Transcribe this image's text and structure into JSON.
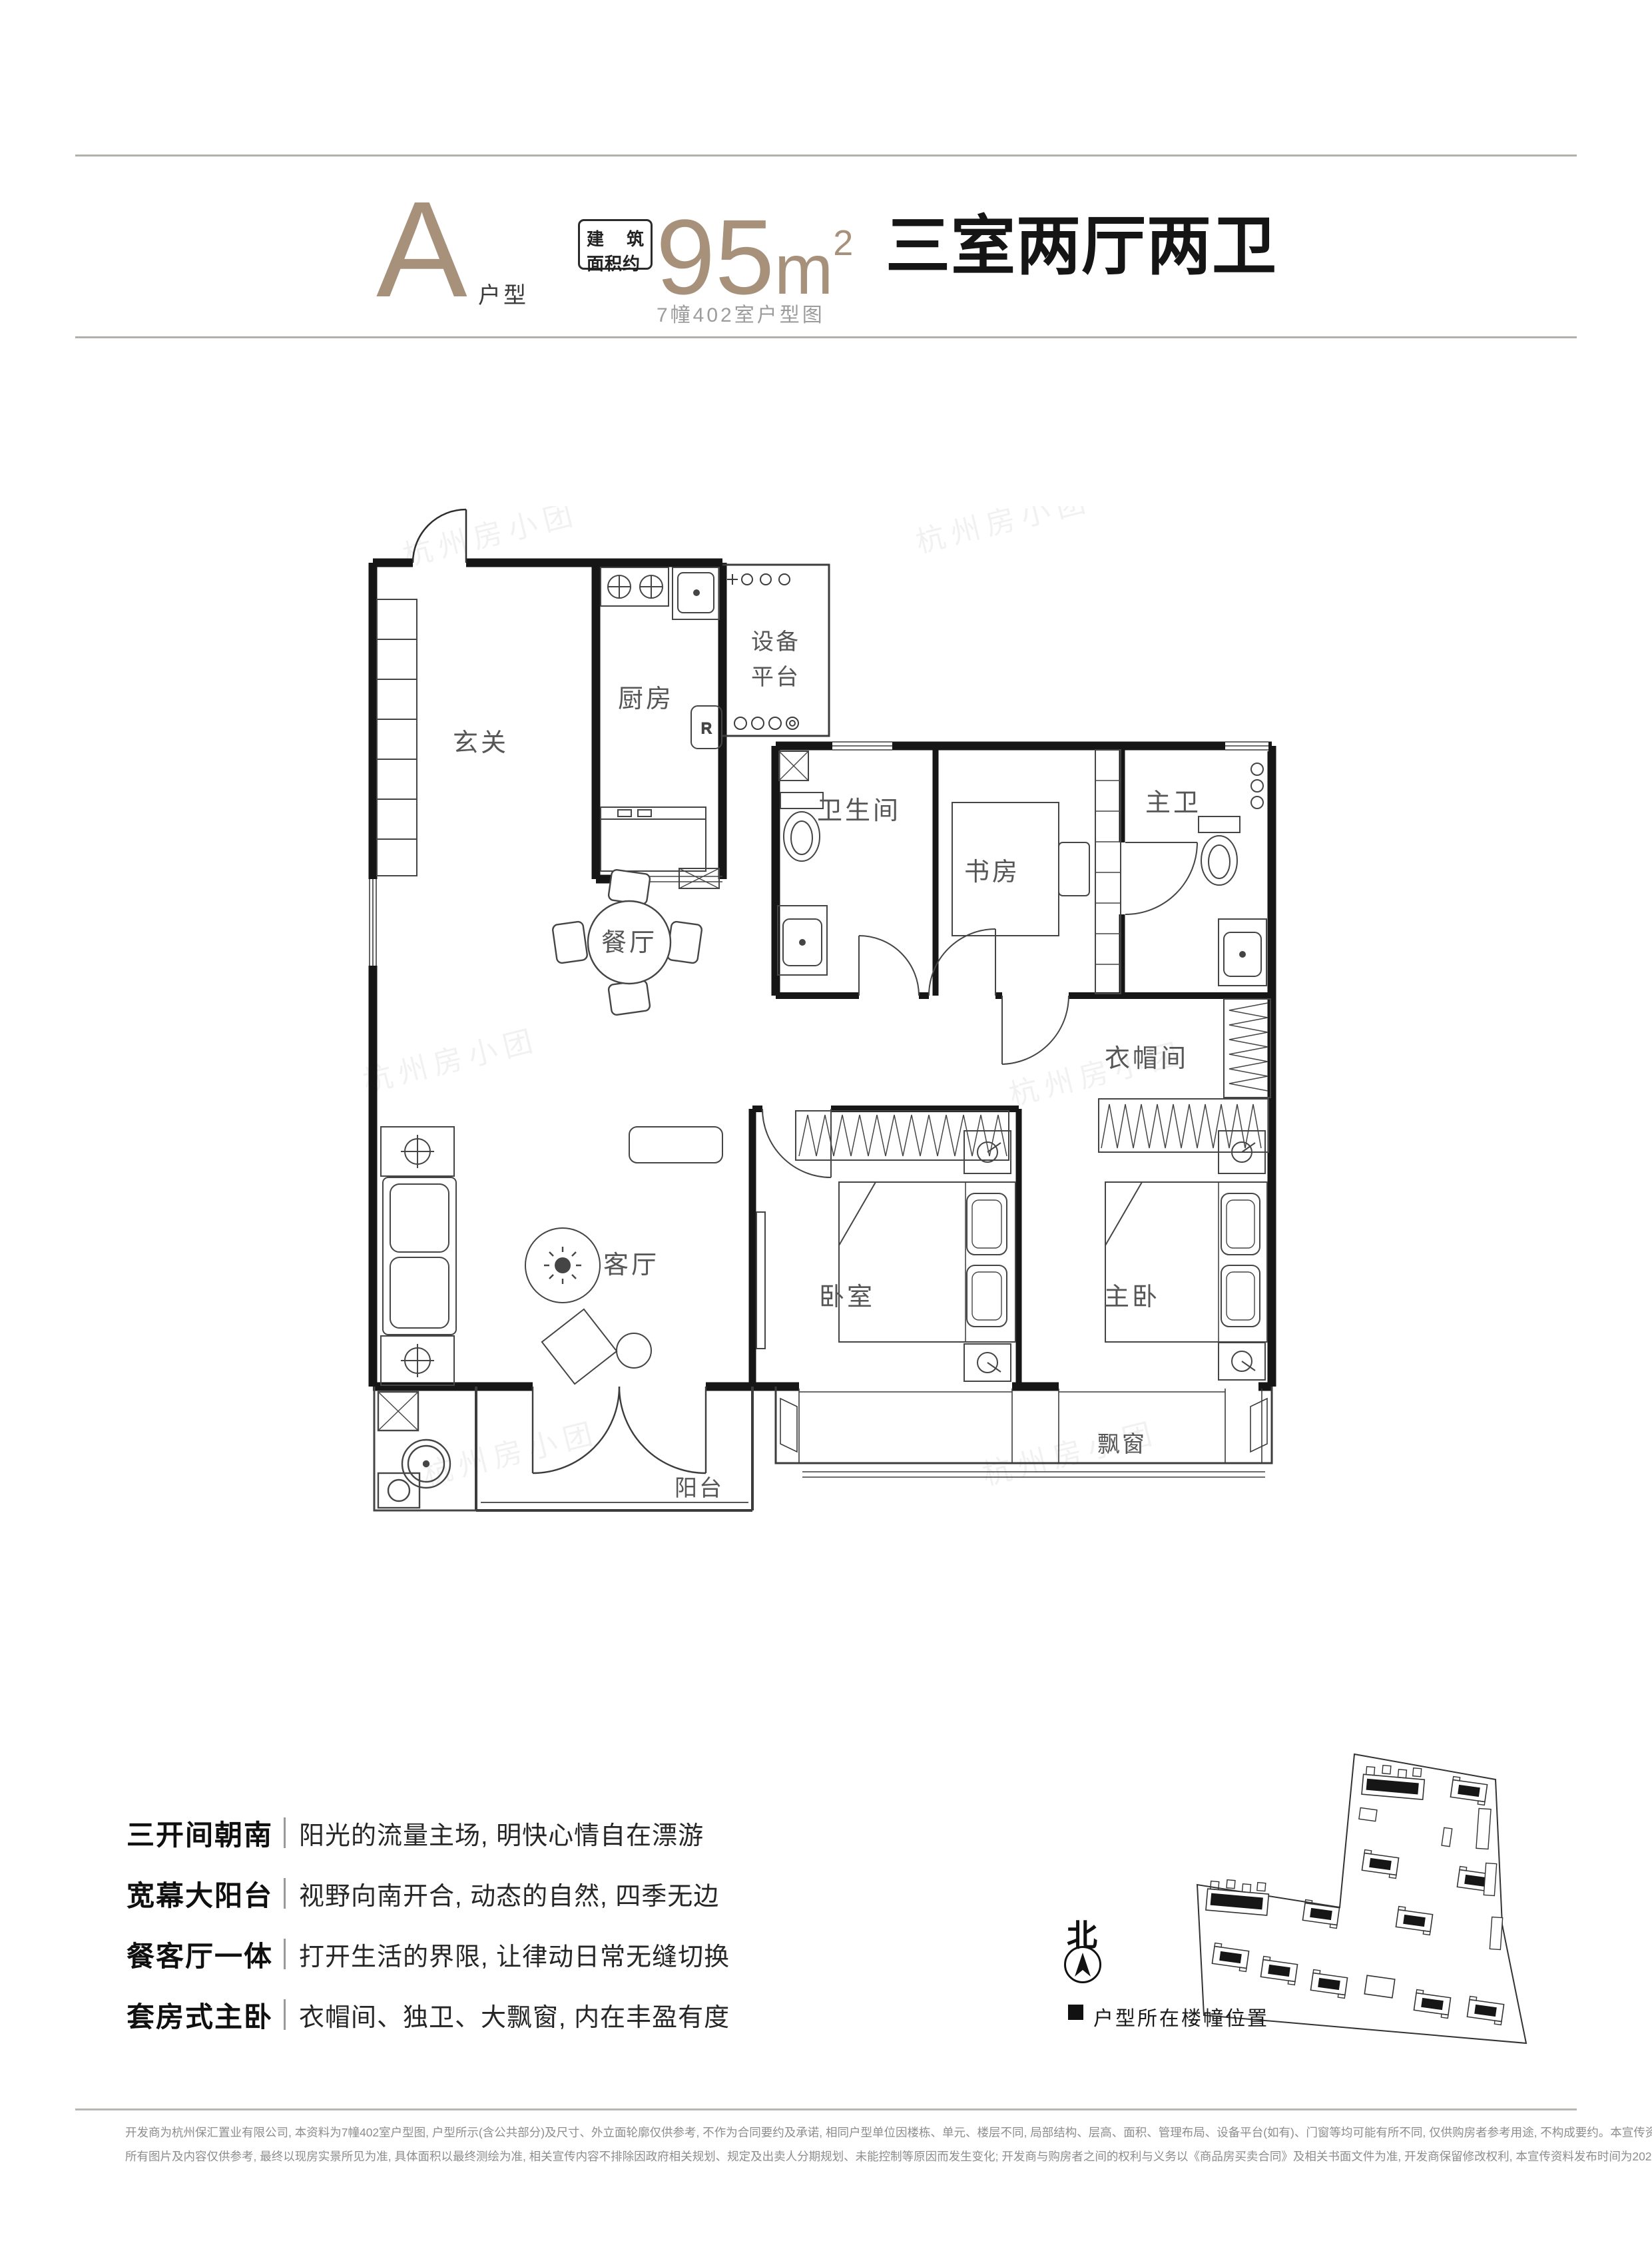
{
  "header": {
    "unit_letter": "A",
    "unit_suffix": "户型",
    "area_box_l1a": "建",
    "area_box_l1b": "筑",
    "area_box_l2": "面积约",
    "area_value": "95",
    "area_unit": "m",
    "area_exponent": "2",
    "headline": "三室两厅两卫",
    "subtitle": "7幢402室户型图"
  },
  "floor_plan": {
    "watermark": "杭州房小团",
    "fridge_label": "R",
    "labels": {
      "entry": "玄关",
      "kitchen": "厨房",
      "platform_1": "设备",
      "platform_2": "平台",
      "bathroom": "卫生间",
      "study": "书房",
      "master_bath": "主卫",
      "dining": "餐厅",
      "cloakroom": "衣帽间",
      "living": "客厅",
      "bedroom": "卧室",
      "master_bedroom": "主卧",
      "bay_window": "飘窗",
      "balcony": "阳台"
    }
  },
  "features": {
    "items": [
      {
        "title": "三开间朝南",
        "desc": "阳光的流量主场, 明快心情自在漂游"
      },
      {
        "title": "宽幕大阳台",
        "desc": "视野向南开合, 动态的自然, 四季无边"
      },
      {
        "title": "餐客厅一体",
        "desc": "打开生活的界限, 让律动日常无缝切换"
      },
      {
        "title": "套房式主卧",
        "desc": "衣帽间、独卫、大飘窗, 内在丰盈有度"
      }
    ]
  },
  "site_plan": {
    "north_label": "北",
    "legend_label": "户型所在楼幢位置"
  },
  "disclaimer": {
    "line1": "开发商为杭州保汇置业有限公司, 本资料为7幢402室户型图, 户型所示(含公共部分)及尺寸、外立面轮廓仅供参考, 不作为合同要约及承诺, 相同户型单位因楼栋、单元、楼层不同, 局部结构、层高、面积、管理布局、设备平台(如有)、门窗等均可能有所不同, 仅供购房者参考用途, 不构成要约。本宣传资料仅作为形象展示,",
    "line2": "所有图片及内容仅供参考, 最终以现房实景所见为准, 具体面积以最终测绘为准, 相关宣传内容不排除因政府相关规划、规定及出卖人分期规划、未能控制等原因而发生变化; 开发商与购房者之间的权利与义务以《商品房买卖合同》及相关书面文件为准, 开发商保留修改权利, 本宣传资料发布时间为2021年8月。"
  }
}
